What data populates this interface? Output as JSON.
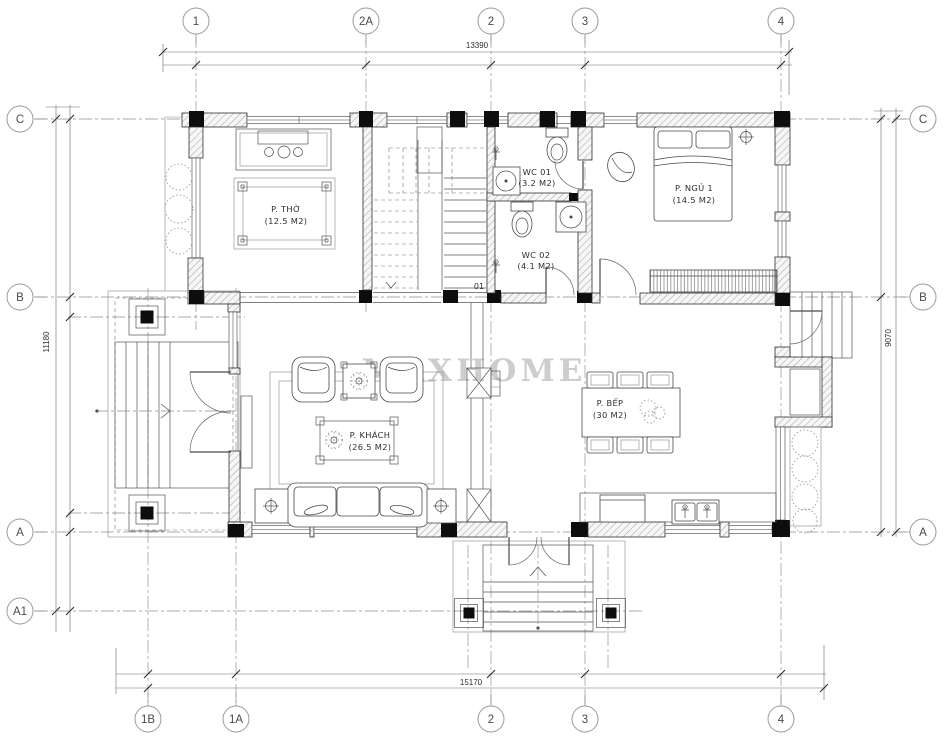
{
  "watermark": "MAXHOME",
  "grid": {
    "top": [
      "1",
      "2A",
      "2",
      "3",
      "4"
    ],
    "bottom": [
      "1B",
      "1A",
      "2",
      "3",
      "4"
    ],
    "left": [
      "C",
      "B",
      "A",
      "A1"
    ],
    "right": [
      "C",
      "B",
      "A"
    ]
  },
  "dimensions": {
    "top": "13390",
    "left": "11180",
    "right": "9070",
    "bottom": "15170"
  },
  "rooms": {
    "tho": {
      "name": "P. THỜ",
      "area": "(12.5 M2)"
    },
    "wc1": {
      "name": "WC 01",
      "area": "(3.2 M2)"
    },
    "wc2": {
      "name": "WC 02",
      "area": "(4.1 M2)"
    },
    "ngu1": {
      "name": "P. NGỦ 1",
      "area": "(14.5 M2)"
    },
    "khach": {
      "name": "P. KHÁCH",
      "area": "(26.5 M2)"
    },
    "bep": {
      "name": "P. BẾP",
      "area": "(30 M2)"
    }
  },
  "tags": {
    "door": "01"
  },
  "colors": {
    "wall_hatch": "#9a9a9a",
    "column": "#0d0d0d",
    "watermark": "#c0c0c0"
  }
}
